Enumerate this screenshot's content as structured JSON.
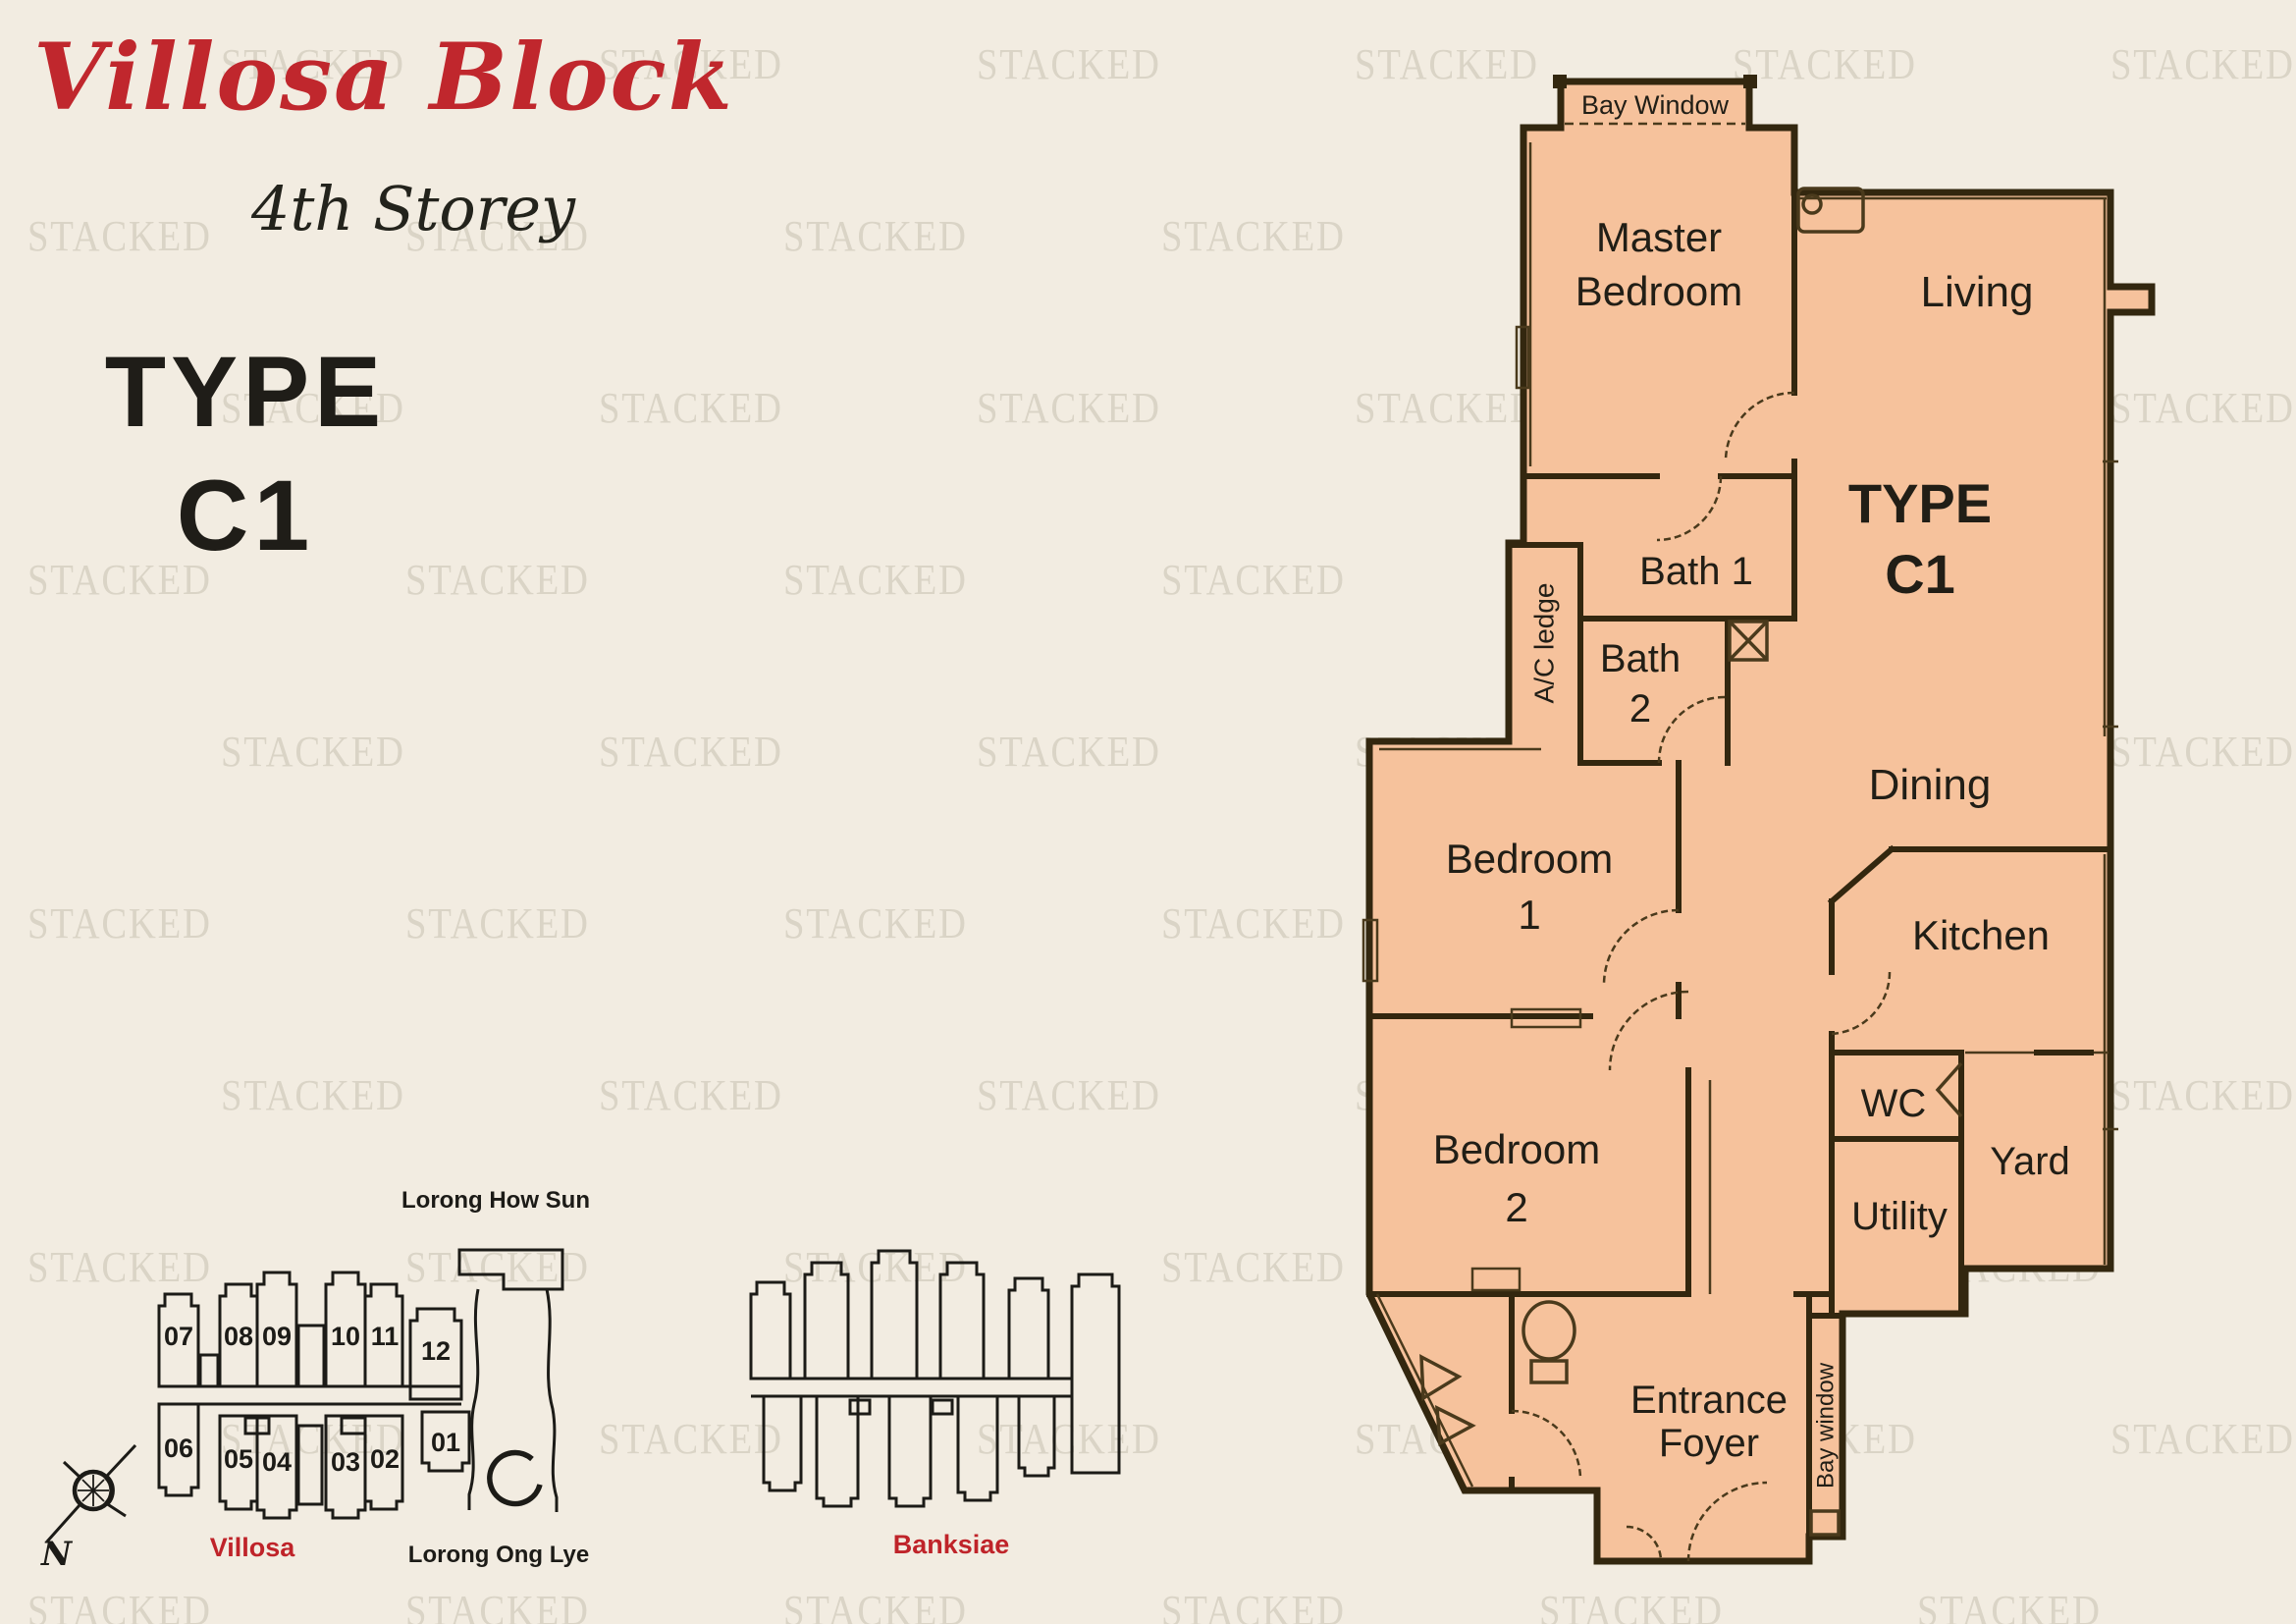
{
  "header": {
    "title": "Villosa Block",
    "subtitle": "4th Storey"
  },
  "unit_type": {
    "line1": "TYPE",
    "line2": "C1"
  },
  "watermark": {
    "text": "STACKED",
    "color": "#d9d2c3",
    "positions": [
      [
        225,
        40
      ],
      [
        610,
        40
      ],
      [
        995,
        40
      ],
      [
        1380,
        40
      ],
      [
        1765,
        40
      ],
      [
        2150,
        40
      ],
      [
        28,
        215
      ],
      [
        413,
        215
      ],
      [
        798,
        215
      ],
      [
        1183,
        215
      ],
      [
        1568,
        215
      ],
      [
        1953,
        215
      ],
      [
        225,
        390
      ],
      [
        610,
        390
      ],
      [
        995,
        390
      ],
      [
        1380,
        390
      ],
      [
        1765,
        390
      ],
      [
        2150,
        390
      ],
      [
        28,
        565
      ],
      [
        413,
        565
      ],
      [
        798,
        565
      ],
      [
        1183,
        565
      ],
      [
        1568,
        565
      ],
      [
        1953,
        565
      ],
      [
        225,
        740
      ],
      [
        610,
        740
      ],
      [
        995,
        740
      ],
      [
        1380,
        740
      ],
      [
        1765,
        740
      ],
      [
        2150,
        740
      ],
      [
        28,
        915
      ],
      [
        413,
        915
      ],
      [
        798,
        915
      ],
      [
        1183,
        915
      ],
      [
        1568,
        915
      ],
      [
        1953,
        915
      ],
      [
        225,
        1090
      ],
      [
        610,
        1090
      ],
      [
        995,
        1090
      ],
      [
        1380,
        1090
      ],
      [
        1765,
        1090
      ],
      [
        2150,
        1090
      ],
      [
        28,
        1265
      ],
      [
        413,
        1265
      ],
      [
        798,
        1265
      ],
      [
        1183,
        1265
      ],
      [
        1568,
        1265
      ],
      [
        1953,
        1265
      ],
      [
        225,
        1440
      ],
      [
        610,
        1440
      ],
      [
        995,
        1440
      ],
      [
        1380,
        1440
      ],
      [
        1765,
        1440
      ],
      [
        2150,
        1440
      ],
      [
        28,
        1615
      ],
      [
        413,
        1615
      ],
      [
        798,
        1615
      ],
      [
        1183,
        1615
      ],
      [
        1568,
        1615
      ],
      [
        1953,
        1615
      ]
    ]
  },
  "floor_plan": {
    "fill_color": "#f6c29c",
    "wall_color": "#33270f",
    "bay_window_top": "Bay Window",
    "master_bedroom": [
      "Master",
      "Bedroom"
    ],
    "living": "Living",
    "type_label": [
      "TYPE",
      "C1"
    ],
    "bath1": "Bath 1",
    "bath2": [
      "Bath",
      "2"
    ],
    "ac_ledge": "A/C ledge",
    "dining": "Dining",
    "bedroom1": [
      "Bedroom",
      "1"
    ],
    "kitchen": "Kitchen",
    "wc": "WC",
    "yard": "Yard",
    "utility": "Utility",
    "bedroom2": [
      "Bedroom",
      "2"
    ],
    "entrance_foyer": [
      "Entrance",
      "Foyer"
    ],
    "bay_window_side": "Bay window"
  },
  "site_plan": {
    "road_top": "Lorong How Sun",
    "road_bottom": "Lorong Ong Lye",
    "block_left": "Villosa",
    "block_right": "Banksiae",
    "units_top": [
      "07",
      "08",
      "09",
      "10",
      "11",
      "12"
    ],
    "units_bottom": [
      "06",
      "05",
      "04",
      "03",
      "02",
      "01"
    ],
    "compass_north": "N",
    "accent_red": "#bf2329"
  },
  "colors": {
    "background": "#f2ece1",
    "title_red": "#c0272d",
    "text_dark": "#22201a"
  }
}
